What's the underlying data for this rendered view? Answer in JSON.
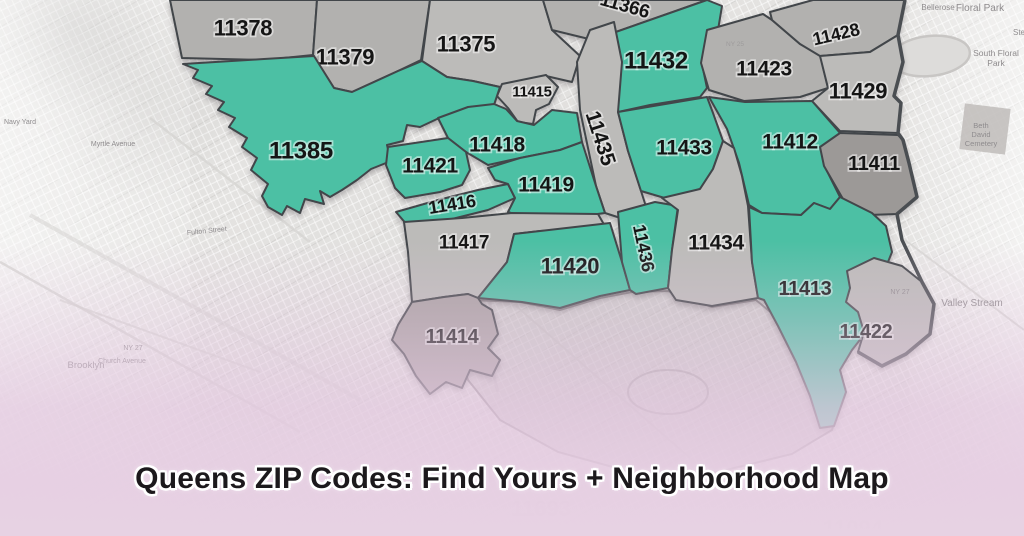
{
  "title": {
    "text": "Queens ZIP Codes: Find Yours + Neighborhood Map"
  },
  "colors": {
    "highlighted_zone": "#4CC0A4",
    "zone_gray": "#B2B1AF",
    "zone_gray_light": "#BCBBB9",
    "zone_gray_dark": "#9C9997",
    "zone_mauve": "#A9A1A2",
    "zone_border": "#42464A",
    "county_border": "#4A4E52",
    "backdrop": "#E4E3E1",
    "pink_overlay": "#E2C7DE",
    "zone_label": "#151515",
    "title_text": "#1C191C"
  },
  "map": {
    "zones": [
      {
        "zip": "11378",
        "highlighted": false
      },
      {
        "zip": "11379",
        "highlighted": false
      },
      {
        "zip": "11375",
        "highlighted": false
      },
      {
        "zip": "11366",
        "highlighted": false,
        "partially_visible": true
      },
      {
        "zip": "11432",
        "highlighted": true
      },
      {
        "zip": "11423",
        "highlighted": false
      },
      {
        "zip": "11428",
        "highlighted": false
      },
      {
        "zip": "11429",
        "highlighted": false
      },
      {
        "zip": "11415",
        "highlighted": false
      },
      {
        "zip": "11435",
        "highlighted": false
      },
      {
        "zip": "11385",
        "highlighted": true
      },
      {
        "zip": "11418",
        "highlighted": true
      },
      {
        "zip": "11421",
        "highlighted": true
      },
      {
        "zip": "11416",
        "highlighted": true
      },
      {
        "zip": "11419",
        "highlighted": true
      },
      {
        "zip": "11433",
        "highlighted": true
      },
      {
        "zip": "11412",
        "highlighted": true
      },
      {
        "zip": "11411",
        "highlighted": false
      },
      {
        "zip": "11417",
        "highlighted": false
      },
      {
        "zip": "11420",
        "highlighted": true
      },
      {
        "zip": "11436",
        "highlighted": true
      },
      {
        "zip": "11434",
        "highlighted": false
      },
      {
        "zip": "11413",
        "highlighted": true
      },
      {
        "zip": "11422",
        "highlighted": false
      },
      {
        "zip": "11414",
        "highlighted": false
      }
    ],
    "background_labels": [
      {
        "text": "Bellerose"
      },
      {
        "text": "Floral Park"
      },
      {
        "text": "Ste"
      },
      {
        "text": "South Floral"
      },
      {
        "text": "Park"
      },
      {
        "text": "Beth"
      },
      {
        "text": "David"
      },
      {
        "text": "Cemetery"
      },
      {
        "text": "NY 25"
      },
      {
        "text": "Valley Stream"
      },
      {
        "text": "NY 27"
      },
      {
        "text": "Brooklyn"
      },
      {
        "text": "Church Avenue"
      },
      {
        "text": "NY 27"
      },
      {
        "text": "Navy Yard"
      },
      {
        "text": "Myrtle Avenue"
      },
      {
        "text": "Fulton Street"
      },
      {
        "text": "11693"
      },
      {
        "text": "11094"
      }
    ]
  }
}
